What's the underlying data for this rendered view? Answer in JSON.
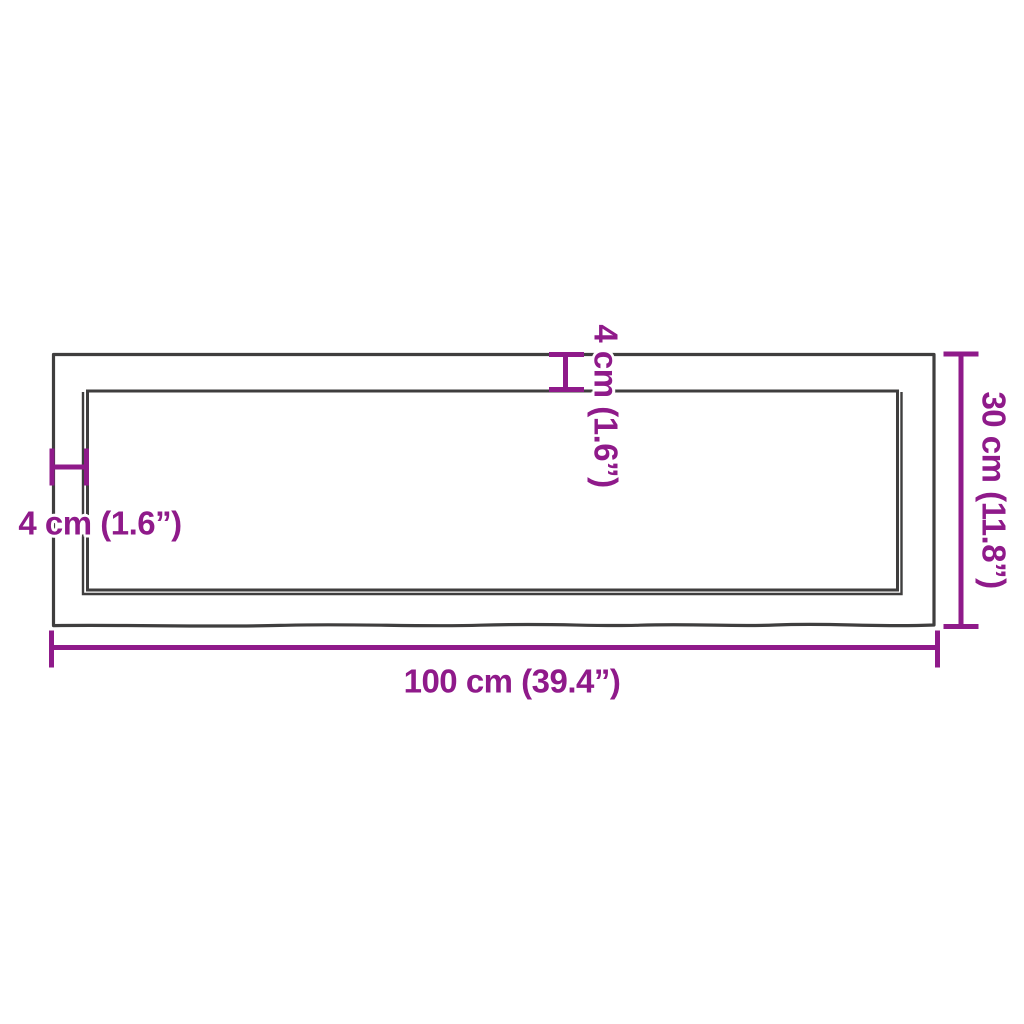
{
  "diagram": {
    "description": "Product dimension diagram of a rectangular wooden wall shelf board with live (wavy) edge, shown top-down with a recessed inner edge",
    "dimensions": {
      "width_label": "100 cm (39.4”)",
      "height_label": "30 cm (11.8”)",
      "thickness_top_label": "4 cm (1.6”)",
      "thickness_left_label": "4 cm (1.6”)"
    },
    "values": {
      "width_cm": 100,
      "width_inches": 39.4,
      "height_cm": 30,
      "height_inches": 11.8,
      "edge_thickness_cm": 4,
      "edge_thickness_inches": 1.6
    },
    "colors": {
      "dimension_accent": "#8f1a8a",
      "board_outline": "#3f3e3e",
      "background": "#ffffff"
    }
  }
}
